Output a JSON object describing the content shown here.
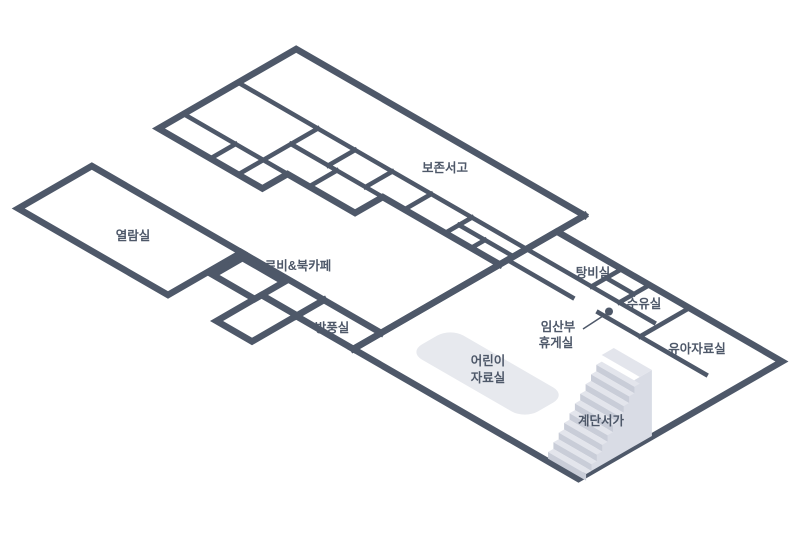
{
  "diagram": {
    "title": "library-floor-plan",
    "rooms": {
      "preservation_stacks": {
        "label": "보존서고"
      },
      "reading_room": {
        "label": "열람실"
      },
      "lobby_bookcafe": {
        "label": "로비&북카페"
      },
      "windbreak_room": {
        "label": "방풍실"
      },
      "pantry": {
        "label": "탕비실"
      },
      "nursing_room": {
        "label": "수유실"
      },
      "pregnant_lounge": {
        "label_line1": "임산부",
        "label_line2": "휴게실"
      },
      "infant_materials_room": {
        "label": "유아자료실"
      },
      "children_materials_room": {
        "label_line1": "어린이",
        "label_line2": "자료실"
      },
      "stair_bookshelf": {
        "label": "계단서가"
      }
    },
    "stairs": {
      "step_count": 10
    },
    "colors": {
      "wall": "#4e5869",
      "text": "#4e5869",
      "stair_tread": "#e3e5ec",
      "stair_riser": "#c9cdd8",
      "stair_side": "#d9dce5",
      "rug": "#e7e9ee",
      "background": "#ffffff"
    }
  }
}
